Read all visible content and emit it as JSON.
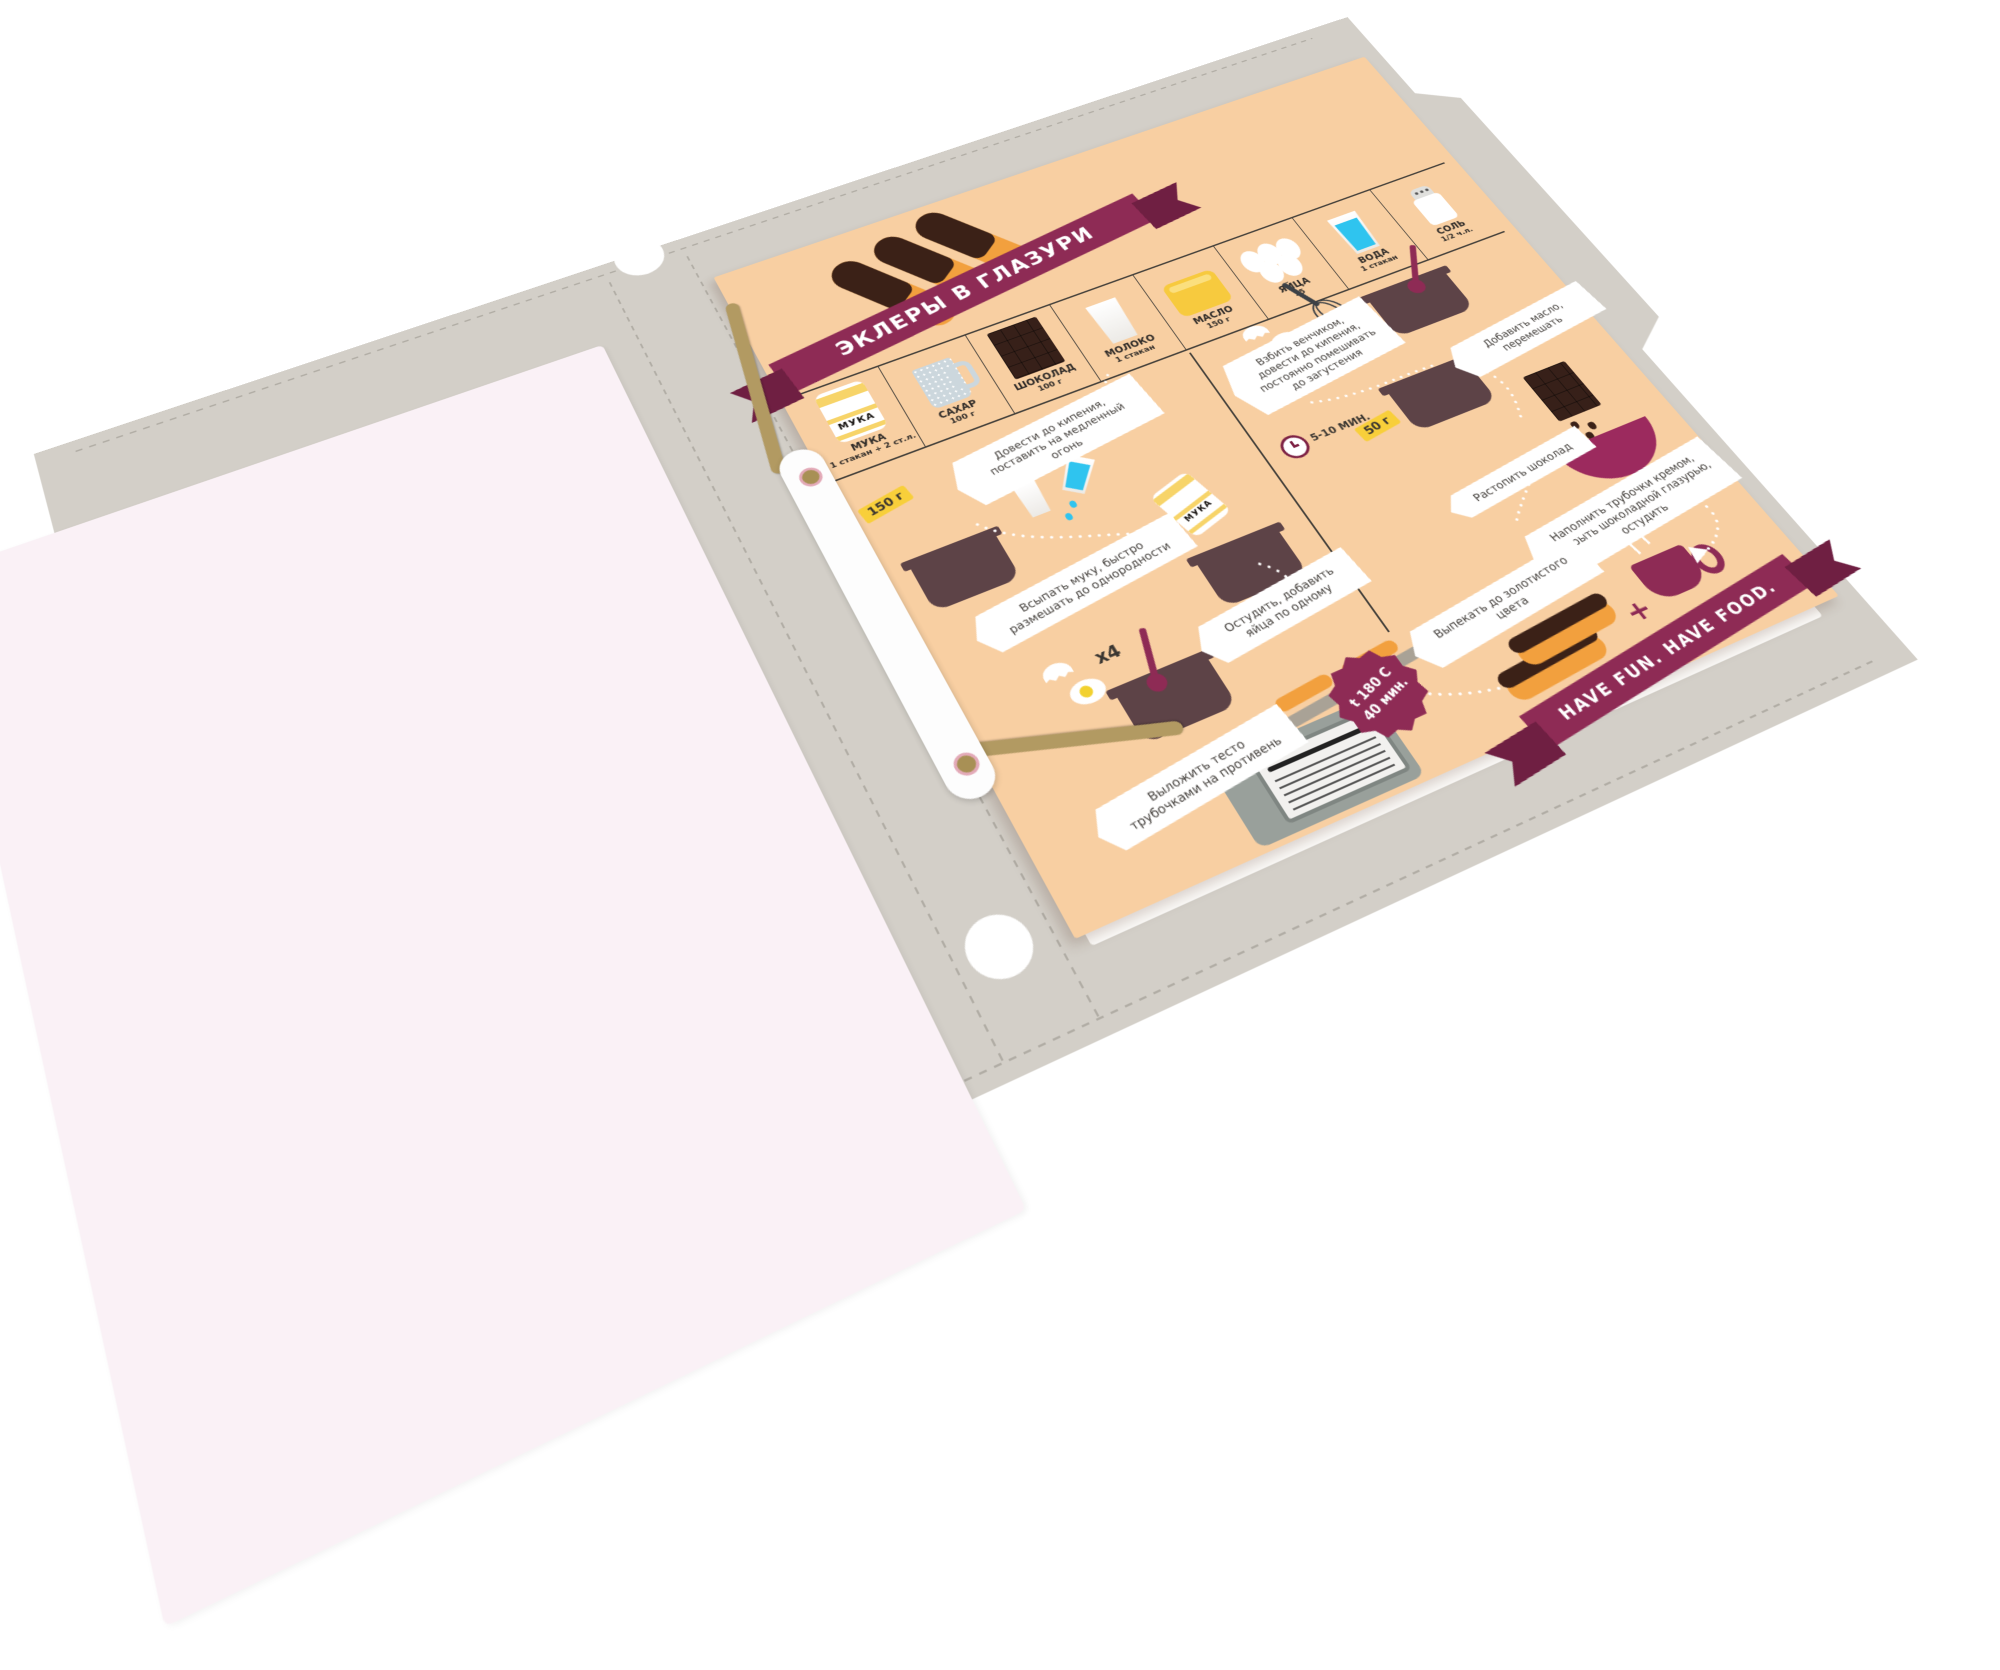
{
  "page": {
    "title": "ЭКЛЕРЫ В ГЛАЗУРИ",
    "footer_ribbon": "HAVE FUN. HAVE FOOD.",
    "flour_bag_label": "МУКА",
    "plus_sign": "+",
    "ingredients": [
      {
        "name": "МУКА",
        "amount": "1 стакан + 2 ст.л.",
        "icon": "flour-bag-icon"
      },
      {
        "name": "САХАР",
        "amount": "100 г",
        "icon": "measuring-cup-icon"
      },
      {
        "name": "ШОКОЛАД",
        "amount": "100 г",
        "icon": "chocolate-bar-icon"
      },
      {
        "name": "МОЛОКО",
        "amount": "1 стакан",
        "icon": "milk-glass-icon"
      },
      {
        "name": "МАСЛО",
        "amount": "150 г",
        "icon": "butter-icon"
      },
      {
        "name": "ЯЙЦА",
        "amount": "х5",
        "icon": "eggs-icon"
      },
      {
        "name": "ВОДА",
        "amount": "1 стакан",
        "icon": "water-glass-icon"
      },
      {
        "name": "СОЛЬ",
        "amount": "1/2 ч.л.",
        "icon": "salt-shaker-icon"
      }
    ],
    "steps_left": [
      "Довести до кипения, поставить на медленный огонь",
      "Всыпать муку, быстро размешать до однородности",
      "Остудить, добавить яйца по одному",
      "Выложить тесто трубочками на противень"
    ],
    "steps_right": [
      "Взбить венчиком, довести до кипения, постоянно помешивать до загустения",
      "Добавить масло, перемешать",
      "Растопить шоколад",
      "Наполнить трубочки кремом, покрыть шоколадной глазурью, остудить",
      "Выпекать до золотистого цвета"
    ],
    "tags": {
      "flour_tag": "150 г",
      "sugar_tag": "50 г",
      "time_tag": "5-10 МИН.",
      "eggs_count": "х4",
      "bake_temp": "t 180 C",
      "bake_time": "40 мин."
    }
  },
  "colors": {
    "folder": "#d3cfc8",
    "stitch": "#b1ada5",
    "pink-page": "#faf1f6",
    "page": "#f8cfa2",
    "ribbon": "#8e2b55",
    "ribbon-dark": "#6f1f42",
    "pot": "#5d4347",
    "chocolate": "#3b2117",
    "eclair": "#f2a03e",
    "yellow-tag": "#f8cf3a",
    "water": "#2fc4ef",
    "ink": "#44403a",
    "steel": "#99a09b"
  }
}
